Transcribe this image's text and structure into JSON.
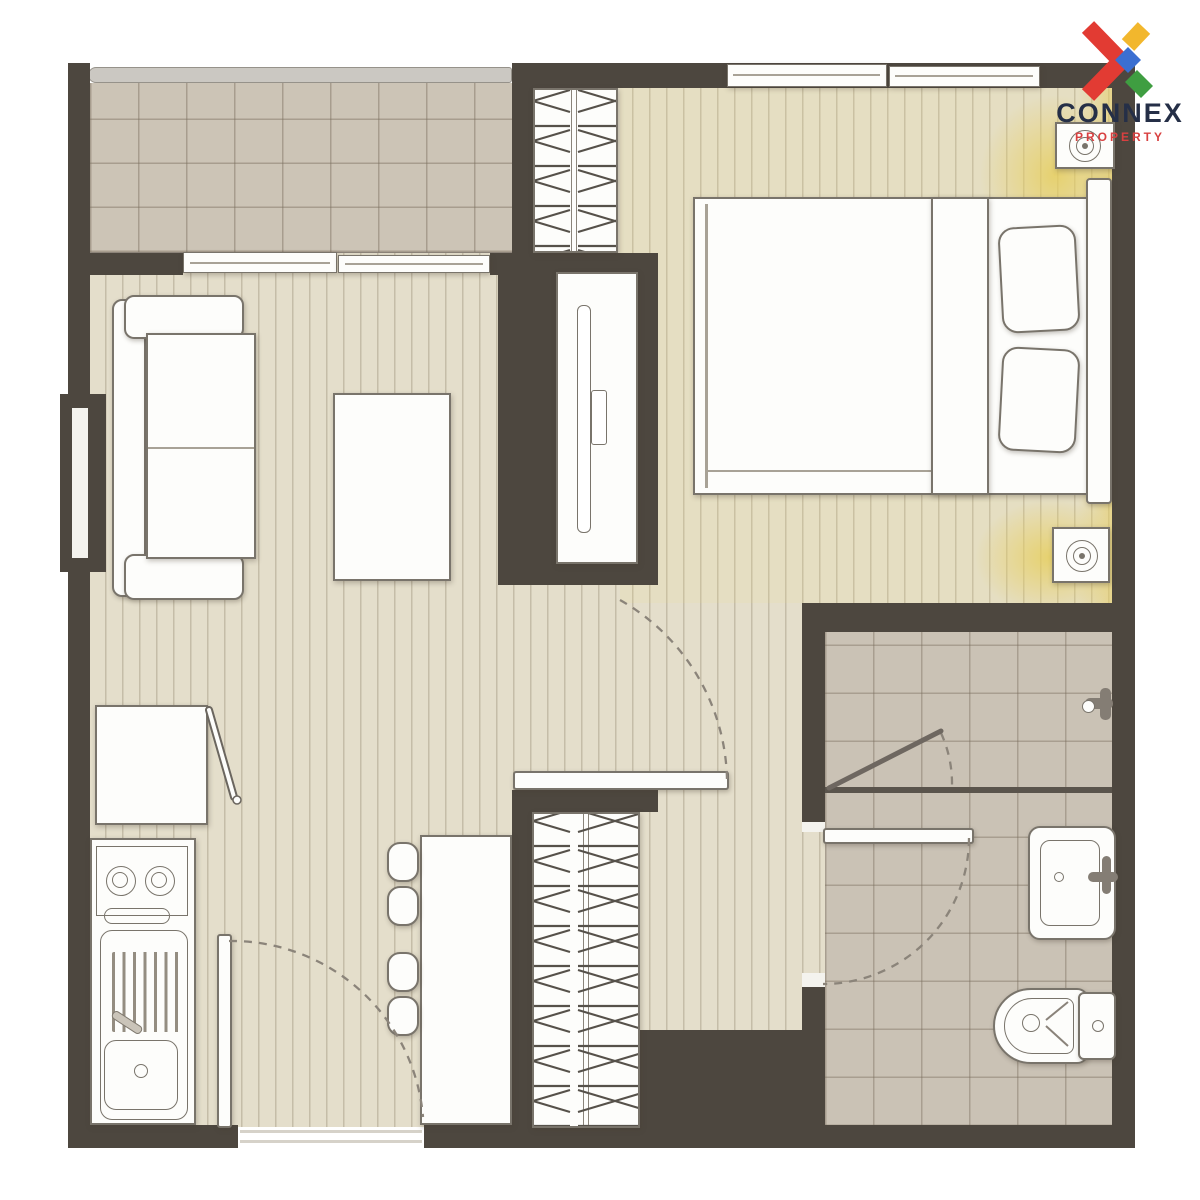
{
  "logo": {
    "brand": "CONNEX",
    "tagline": "PROPERTY",
    "brand_color": "#252f47",
    "tagline_color": "#d84040",
    "mark_colors": {
      "red": "#e23b33",
      "yellow": "#f2b72d",
      "blue": "#3b6fd1",
      "green": "#3f9e41"
    }
  },
  "palette": {
    "background": "#ffffff",
    "wall": "#4d473f",
    "wood_floor": "#e4decb",
    "plank_line": "#b0a586",
    "balcony_tile": "#ccc4b6",
    "bathroom_tile": "#cac2b5",
    "tile_line": "#9f9585",
    "railing": "#cbc8c2",
    "furniture_fill": "#fdfdfb",
    "furniture_outline": "#79746b",
    "door_swing_dash": "#8b847a",
    "accent_glow": "#e7ce6b"
  },
  "floor_plan": {
    "type": "one-bedroom condominium unit, top-down furnished floor plan",
    "rooms": [
      {
        "name": "balcony",
        "position": "top-left",
        "features": [
          "tiled floor",
          "railing",
          "sliding glass door to living room"
        ]
      },
      {
        "name": "living-dining-area",
        "position": "center-left",
        "furniture": [
          "two-seat sofa",
          "coffee table",
          "tv-console in wall niche",
          "dining table",
          "stool",
          "stool"
        ]
      },
      {
        "name": "kitchen",
        "position": "bottom-left",
        "furniture": [
          "refrigerator with open door",
          "two-burner stove counter",
          "sink with drainboard"
        ]
      },
      {
        "name": "bedroom",
        "position": "top-right",
        "furniture": [
          "double bed with folded blanket",
          "pillow",
          "pillow",
          "headboard",
          "hatched wardrobe",
          "air-conditioner unit",
          "air-conditioner unit",
          "window",
          "window"
        ]
      },
      {
        "name": "hallway",
        "position": "center-right",
        "furniture": [
          "built-in hatched closet"
        ]
      },
      {
        "name": "bathroom",
        "position": "bottom-right",
        "features": [
          "tiled floor",
          "washbasin with faucet",
          "toilet with tank",
          "shower partition",
          "open shower glass door",
          "shower valve"
        ]
      }
    ],
    "doors": [
      {
        "name": "entrance-door",
        "location": "bottom wall near kitchen",
        "shown": "open leaf with dashed swing arc"
      },
      {
        "name": "bedroom-door",
        "location": "between living area and bedroom",
        "shown": "open leaf with dashed swing arc"
      },
      {
        "name": "bathroom-door",
        "location": "bathroom left wall",
        "shown": "open leaf with dashed swing arc"
      },
      {
        "name": "shower-door",
        "location": "inside bathroom",
        "shown": "open glass leaf with dashed swing arc"
      }
    ]
  }
}
